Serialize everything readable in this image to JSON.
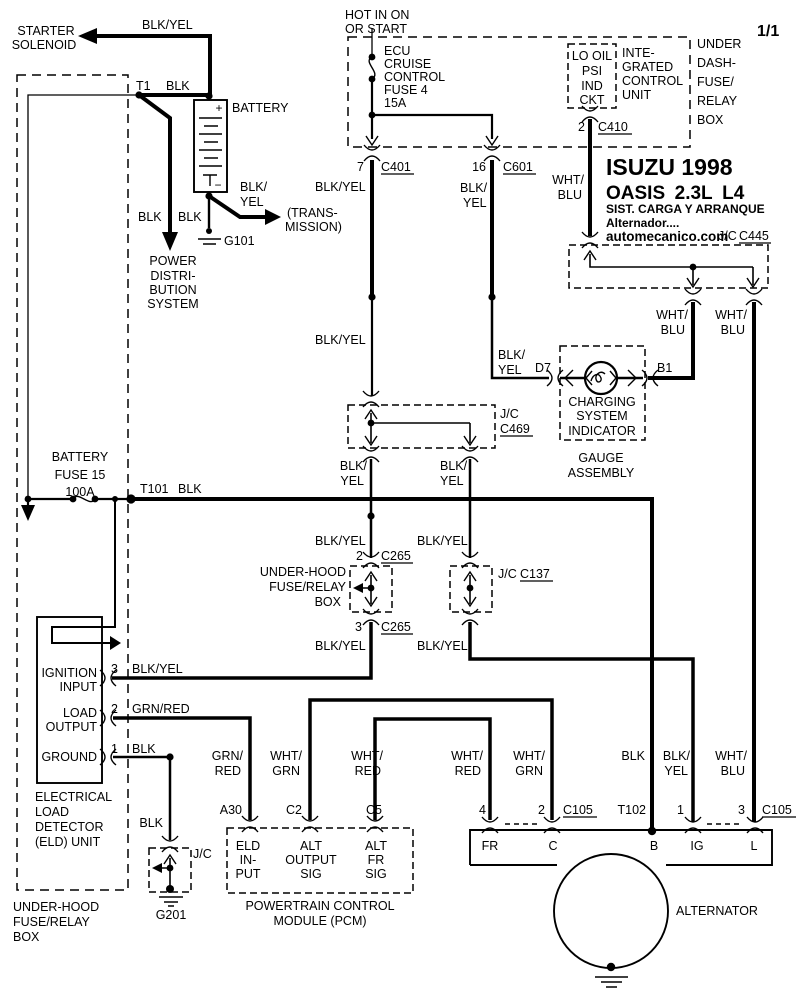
{
  "sheet": "1/1",
  "title_block": {
    "l1": "ISUZU 1998",
    "l2": "OASIS 2.3L L4",
    "l3": "SIST. CARGA Y ARRANQUE",
    "l4": "Alternador....",
    "l5": "automecanico.com"
  },
  "colors": {
    "line": "#000000",
    "background": "#ffffff"
  },
  "labels": {
    "starter": [
      "STARTER",
      "SOLENOID"
    ],
    "batt_feed": "BLK/YEL",
    "t1": "T1",
    "t1_color": "BLK",
    "battery": "BATTERY",
    "plus": "+",
    "minus": "−",
    "blk_pwr": "BLK",
    "blk_gnd101": "BLK",
    "g101": "G101",
    "trans_color": [
      "BLK/",
      "YEL"
    ],
    "transmission": [
      "(TRANS-",
      "MISSION)"
    ],
    "power_dist": [
      "POWER",
      "DISTRI-",
      "BUTION",
      "SYSTEM"
    ],
    "hot": [
      "HOT IN ON",
      "OR START"
    ],
    "ecu_fuse": [
      "ECU",
      "CRUISE",
      "CONTROL",
      "FUSE 4",
      "15A"
    ],
    "pin7": "7",
    "c401": "C401",
    "pin16": "16",
    "c601": "C601",
    "c401_color": "BLK/YEL",
    "c601_color": [
      "BLK/",
      "YEL"
    ],
    "lo_oil": [
      "LO OIL",
      "PSI",
      "IND",
      "CKT"
    ],
    "icu": [
      "INTE-",
      "GRATED",
      "CONTROL",
      "UNIT"
    ],
    "under_dash": [
      "UNDER",
      "DASH-",
      "FUSE/",
      "RELAY",
      "BOX"
    ],
    "pin2_c410": "2",
    "c410": "C410",
    "c410_color": [
      "WHT/",
      "BLU"
    ],
    "jc445_prefix": "J/C",
    "c445": "C445",
    "c445_l": [
      "WHT/",
      "BLU"
    ],
    "c445_r": [
      "WHT/",
      "BLU"
    ],
    "c401_mid": "BLK/YEL",
    "d7_color": [
      "BLK/",
      "YEL"
    ],
    "d7": "D7",
    "b1": "B1",
    "indicator": [
      "CHARGING",
      "SYSTEM",
      "INDICATOR"
    ],
    "gauge": [
      "GAUGE",
      "ASSEMBLY"
    ],
    "jc469_prefix": "J/C",
    "c469": "C469",
    "c469_l": [
      "BLK/",
      "YEL"
    ],
    "c469_r": [
      "BLK/",
      "YEL"
    ],
    "bat_fuse": [
      "BATTERY",
      "FUSE 15",
      "100A"
    ],
    "t101": "T101",
    "t101_color": "BLK",
    "c265u_l": "BLK/YEL",
    "c265u_r": "BLK/YEL",
    "pin2_c265": "2",
    "c265a": "C265",
    "pin3_c265": "3",
    "c265b": "C265",
    "uh_mid": [
      "UNDER-HOOD",
      "FUSE/RELAY",
      "BOX"
    ],
    "jc137_prefix": "J/C",
    "c137": "C137",
    "c265d_l": "BLK/YEL",
    "c265d_r": "BLK/YEL",
    "eld_ign": [
      "IGNITION",
      "INPUT"
    ],
    "eld_load": [
      "LOAD",
      "OUTPUT"
    ],
    "eld_gnd": "GROUND",
    "pin3_eld": "3",
    "ign_color": "BLK/YEL",
    "pin2_eld": "2",
    "load_color": "GRN/RED",
    "pin1_eld": "1",
    "gnd_color": "BLK",
    "eld_unit": [
      "ELECTRICAL",
      "LOAD",
      "DETECTOR",
      "(ELD) UNIT"
    ],
    "uh_bot": [
      "UNDER-HOOD",
      "FUSE/RELAY",
      "BOX"
    ],
    "g201_color": "BLK",
    "jc201": "J/C",
    "g201": "G201",
    "a30_color": [
      "GRN/",
      "RED"
    ],
    "c2_color": [
      "WHT/",
      "GRN"
    ],
    "c5_color": [
      "WHT/",
      "RED"
    ],
    "a30": "A30",
    "c2": "C2",
    "c5": "C5",
    "pcm_eld": [
      "ELD",
      "IN-",
      "PUT"
    ],
    "pcm_out": [
      "ALT",
      "OUTPUT",
      "SIG"
    ],
    "pcm_fr": [
      "ALT",
      "FR",
      "SIG"
    ],
    "pcm": [
      "POWERTRAIN CONTROL",
      "MODULE (PCM)"
    ],
    "fr_color": [
      "WHT/",
      "RED"
    ],
    "c_color": [
      "WHT/",
      "GRN"
    ],
    "b_color": "BLK",
    "ig_color": [
      "BLK/",
      "YEL"
    ],
    "l_color": [
      "WHT/",
      "BLU"
    ],
    "pin4": "4",
    "pin2_c105": "2",
    "c105a": "C105",
    "t102": "T102",
    "pin1_c105": "1",
    "pin3_c105": "3",
    "c105b": "C105",
    "term": [
      "FR",
      "C",
      "B",
      "IG",
      "L"
    ],
    "alternator": "ALTERNATOR"
  }
}
